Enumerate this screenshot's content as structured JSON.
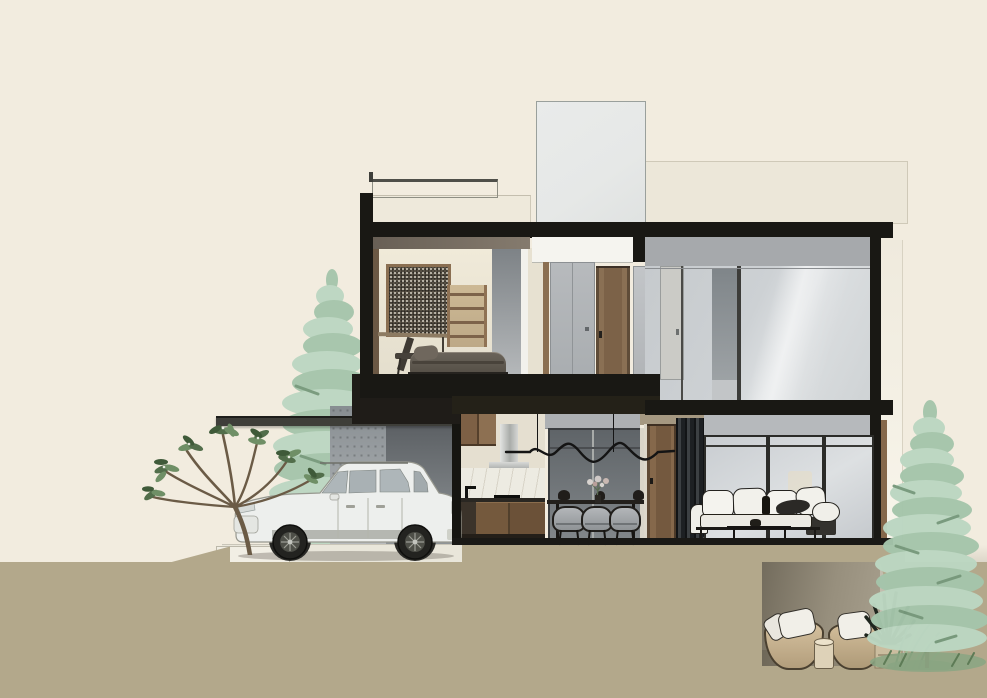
{
  "scene": {
    "type": "architectural-section-elevation-rendering",
    "style": "flat watercolor architectural section of a modern two-storey hillside house",
    "text_visible": "none",
    "exterior": {
      "rooftop": [
        "glass-roof-railing",
        "left-parapet",
        "skylight-bulkhead",
        "right-parapet"
      ],
      "structure": [
        "flat-roof-slab",
        "left-column",
        "right-column",
        "white-side-wall"
      ],
      "carport": [
        "cantilevered-carport-roof",
        "concrete-pillar",
        "dark-side-wall",
        "white-suv-car",
        "paved-driveway",
        "curb"
      ]
    },
    "upper_floor": {
      "bedroom": [
        "framed-speckled-artwork",
        "wall-desk",
        "ladder-shelf",
        "desk-chair",
        "upholstered-bed"
      ],
      "hall": [
        "white-transom-panel",
        "gray-sliding-panel",
        "wood-door",
        "gray-door"
      ],
      "right_bay": [
        "gray-transom-band",
        "full-height-window",
        "gray-wall-panel",
        "light-interior-door"
      ]
    },
    "lower_floor": {
      "kitchen": [
        "wood-upper-cabinet",
        "stainless-range-hood",
        "marble-backsplash",
        "black-faucet",
        "cooktop",
        "wood-base-cabinets"
      ],
      "dining": [
        "wavy-pendant-light",
        "dark-glazed-wall",
        "dining-table",
        "three-gray-chairs",
        "flower-vase",
        "black-teapots"
      ],
      "entry": [
        "wood-door",
        "dark-curtain"
      ],
      "living": [
        "sliding-glass-doors",
        "white-sectional-sofa",
        "dark-throw-blanket",
        "coffee-table",
        "white-pouf"
      ]
    },
    "site": {
      "ground": [
        "tan-earth-mass",
        "sloped-left-terrain",
        "sunken-patio-recess"
      ],
      "patio": [
        "two-rattan-basket-chairs",
        "white-cushions",
        "round-side-table",
        "potted-dark-plant",
        "grasses"
      ],
      "planting": [
        "frangipani-tree",
        "left-pine-tree",
        "right-pine-tree",
        "grass-tufts"
      ]
    }
  },
  "palette": {
    "bg": "#f2ecdf",
    "structure": "#191814",
    "parapet": "#ece7d9",
    "skylight": "#e6e8e7",
    "cream-strip": "#e7e1d1",
    "white-panel": "#f5f4ef",
    "band-gray": "#a6a9ac",
    "panel-gray-light": "#b6b9bc",
    "glass-light": "#dde0e2",
    "wood": "#85684b",
    "marble": "#edebe2",
    "sofa": "#f0efe9",
    "cushion": "#f1efe8",
    "ground": "#b3a88b",
    "ground-light": "#c3bdae",
    "pavement": "#e9e6da",
    "curb": "#f1eee4",
    "pine": "#bcd7c2",
    "pine-deep": "#a5c5ab",
    "pine-accent": "#77997c",
    "trunk": "#77674f",
    "branch": "#6b5b46",
    "leaf": "#526e4b",
    "leaf-light": "#6f8f66",
    "leaf-deep": "#3f5a39",
    "art-frame": "#8a6f52",
    "car-body": "#edefed",
    "car-line": "#97988f",
    "basket": "#ccb795"
  }
}
